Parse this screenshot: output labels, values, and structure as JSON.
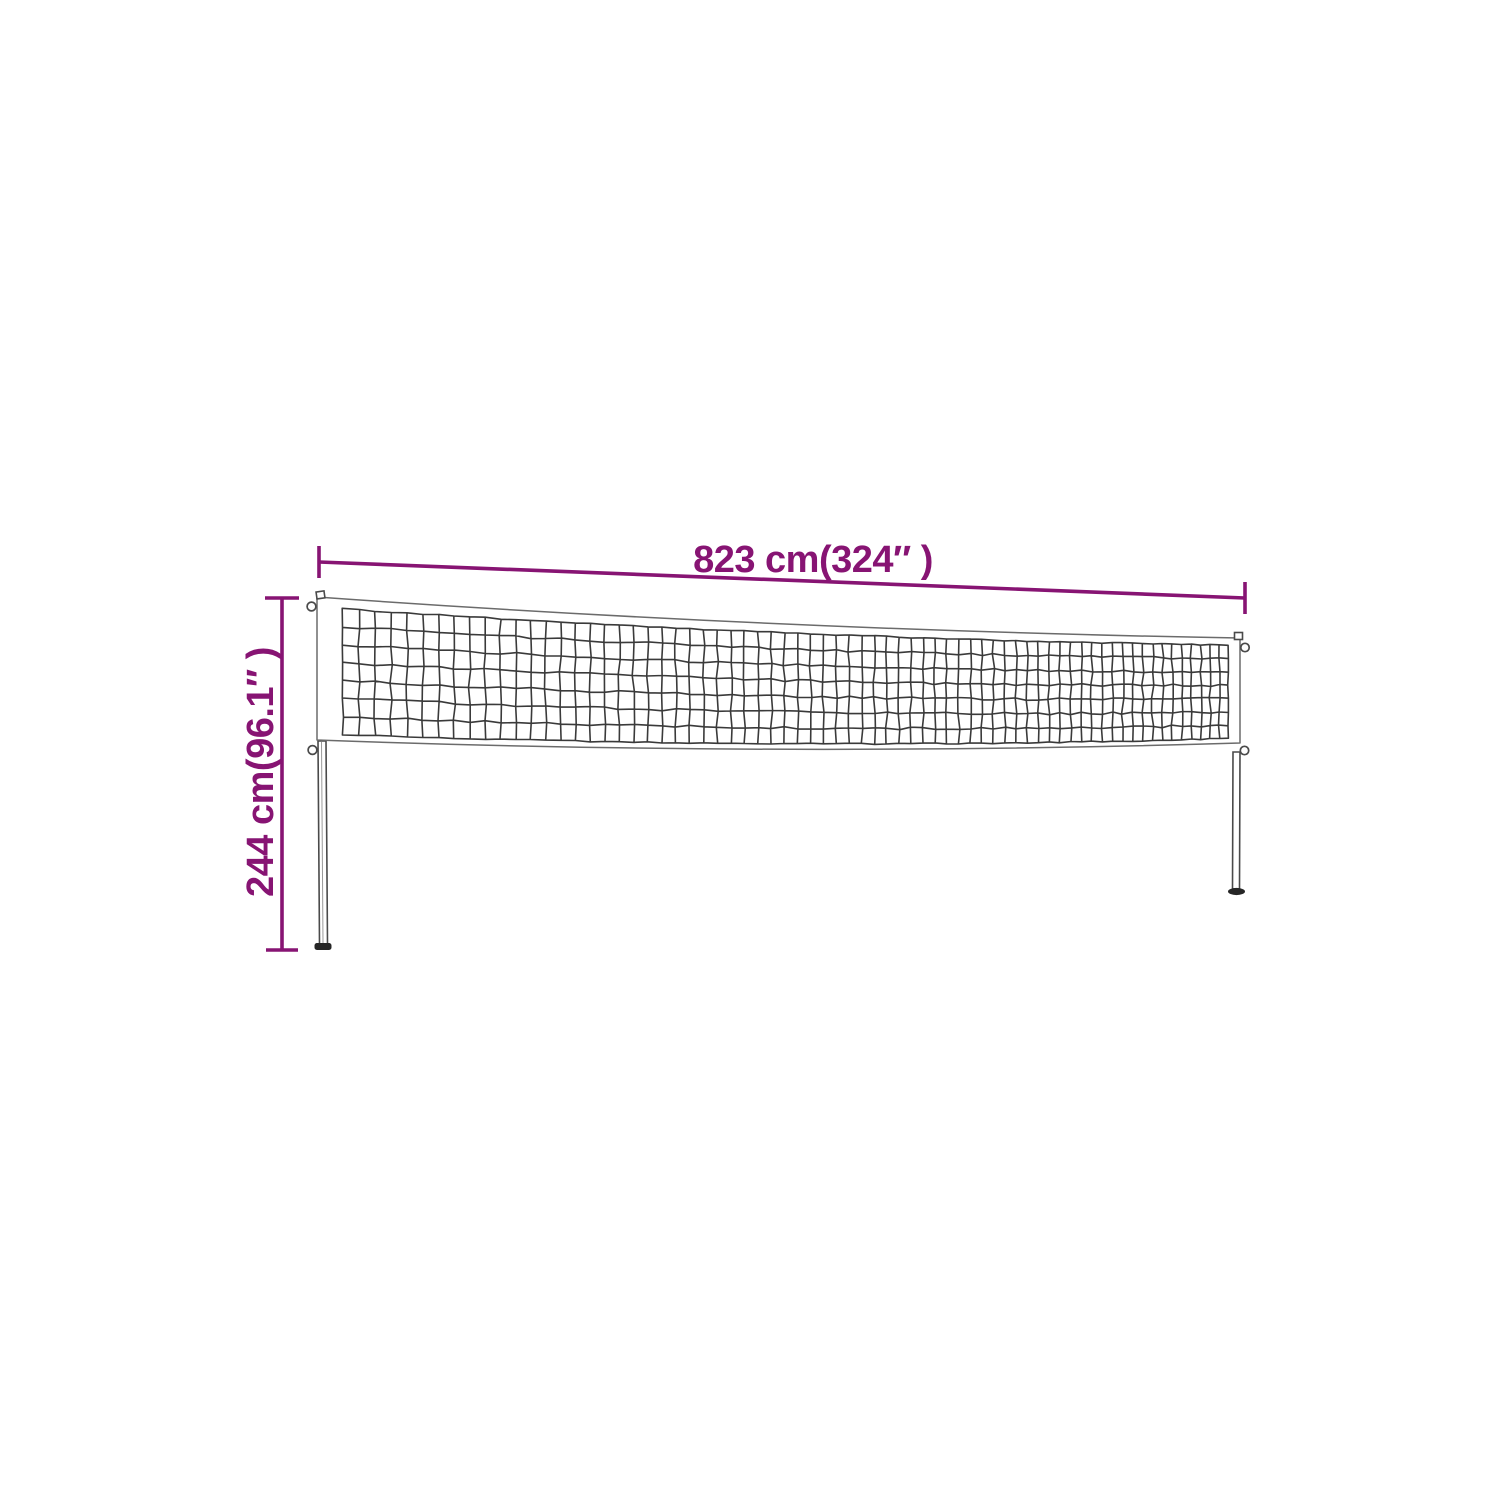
{
  "figure": {
    "type": "product-dimension-diagram",
    "subject": "volleyball-badminton-net-with-posts",
    "width_label": "823 cm(324″ )",
    "height_label": "244 cm(96.1″ )",
    "colors": {
      "dimension": "#871473",
      "mesh_line": "#3a3a3a",
      "band_outline": "#6b6b6b",
      "pole_outline": "#4a4a4a",
      "base_fill": "#262626",
      "background": "#ffffff"
    },
    "net_geometry_note": "net band sags slightly from left post (taller, nearer) to right post (shorter, farther)"
  }
}
